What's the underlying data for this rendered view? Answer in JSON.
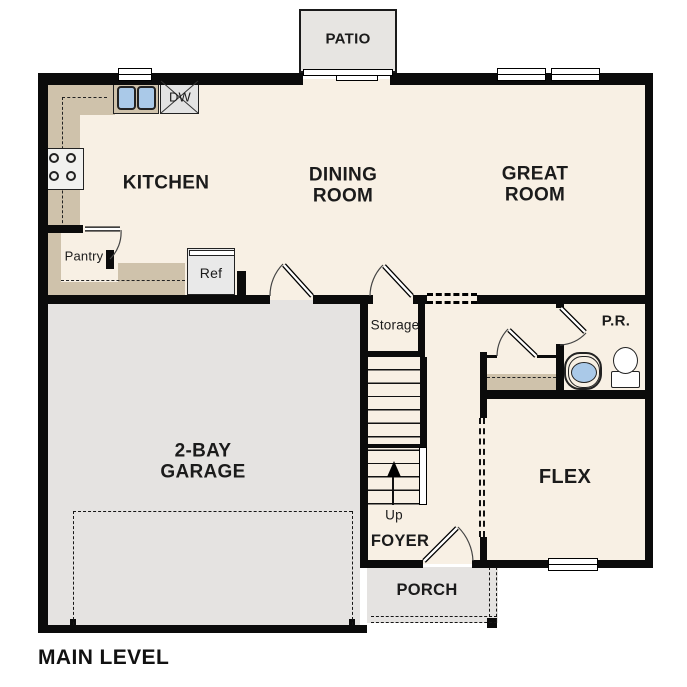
{
  "title": "MAIN LEVEL",
  "colors": {
    "wall": "#0b0b0b",
    "floor": "#f8f0e4",
    "garage_patio_porch": "#e5e3e1",
    "counter": "#cfc2ab",
    "fixture_blue": "#aac9e8"
  },
  "rooms": {
    "patio": "PATIO",
    "kitchen": "KITCHEN",
    "dining_room": "DINING\nROOM",
    "great_room": "GREAT\nROOM",
    "garage": "2-BAY\nGARAGE",
    "storage": "Storage",
    "powder_room": "P.R.",
    "flex": "FLEX",
    "foyer": "FOYER",
    "porch": "PORCH"
  },
  "fixtures": {
    "pantry": "Pantry",
    "refrigerator": "Ref",
    "dishwasher": "DW",
    "stairs_direction": "Up"
  }
}
